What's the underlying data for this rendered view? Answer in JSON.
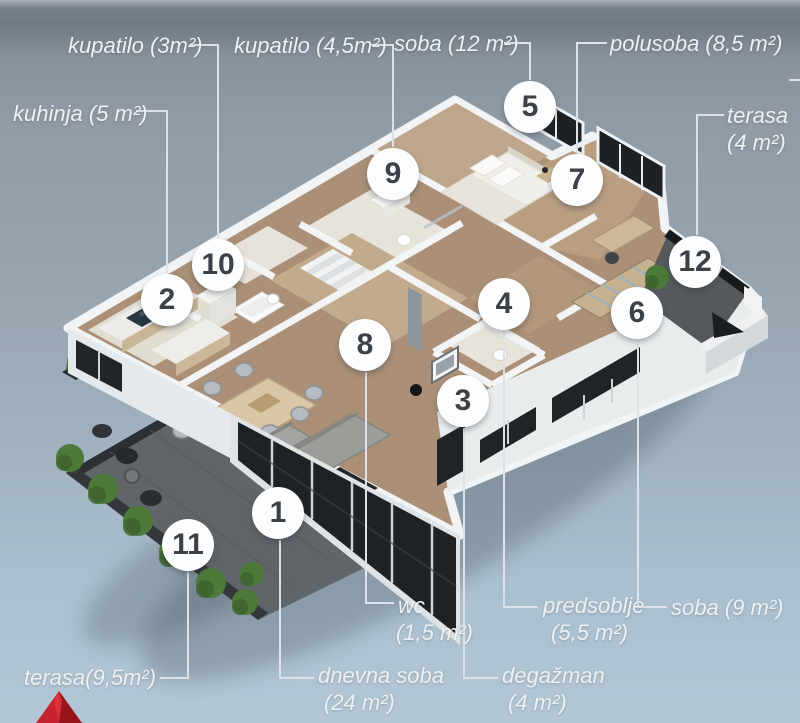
{
  "page": {
    "type": "apartment-floor-plan",
    "view": "3d-isometric"
  },
  "floor_plan": {
    "markers": [
      {
        "number": "1",
        "x": 278,
        "y": 513,
        "room": "dnevna soba"
      },
      {
        "number": "2",
        "x": 167,
        "y": 300,
        "room": "kuhinja"
      },
      {
        "number": "3",
        "x": 463,
        "y": 401,
        "room": "degažman"
      },
      {
        "number": "4",
        "x": 504,
        "y": 304,
        "room": "predsoblje"
      },
      {
        "number": "5",
        "x": 530,
        "y": 107,
        "room": "soba 12 m²"
      },
      {
        "number": "6",
        "x": 637,
        "y": 313,
        "room": "soba 9 m²"
      },
      {
        "number": "7",
        "x": 577,
        "y": 180,
        "room": "polusoba"
      },
      {
        "number": "8",
        "x": 365,
        "y": 345,
        "room": "wc"
      },
      {
        "number": "9",
        "x": 393,
        "y": 174,
        "room": "kupatilo 4,5 m²"
      },
      {
        "number": "10",
        "x": 218,
        "y": 265,
        "room": "kupatilo 3 m²"
      },
      {
        "number": "11",
        "x": 188,
        "y": 545,
        "room": "terasa 9,5 m²"
      },
      {
        "number": "12",
        "x": 695,
        "y": 262,
        "room": "terasa 4 m²"
      }
    ],
    "labels": [
      {
        "id": "kupatilo-3",
        "lines": [
          "kupatilo (3m²)"
        ],
        "x": 68,
        "y": 32,
        "align": "left"
      },
      {
        "id": "kupatilo-45",
        "lines": [
          "kupatilo (4,5m²)"
        ],
        "x": 234,
        "y": 32,
        "align": "left"
      },
      {
        "id": "soba-12",
        "lines": [
          "soba (12 m²)"
        ],
        "x": 394,
        "y": 30,
        "align": "left"
      },
      {
        "id": "polusoba-85",
        "lines": [
          "polusoba (8,5 m²)"
        ],
        "x": 610,
        "y": 30,
        "align": "left"
      },
      {
        "id": "kuhinja-5",
        "lines": [
          "kuhinja (5 m²)"
        ],
        "x": 13,
        "y": 100,
        "align": "left"
      },
      {
        "id": "terasa-4",
        "lines": [
          "terasa",
          "(4 m²)"
        ],
        "x": 727,
        "y": 102,
        "align": "left"
      },
      {
        "id": "terasa-95",
        "lines": [
          "terasa(9,5m²)"
        ],
        "x": 24,
        "y": 664,
        "align": "left"
      },
      {
        "id": "dnevna-soba",
        "lines": [
          "dnevna soba",
          "(24 m²)"
        ],
        "x": 318,
        "y": 662,
        "align": "left",
        "indent2": 6
      },
      {
        "id": "wc",
        "lines": [
          "wc",
          "(1,5 m²)"
        ],
        "x": 398,
        "y": 592,
        "align": "left",
        "indent2": -2
      },
      {
        "id": "predsoblje",
        "lines": [
          "predsoblje",
          "(5,5 m²)"
        ],
        "x": 543,
        "y": 592,
        "align": "left",
        "indent2": 8
      },
      {
        "id": "degazman",
        "lines": [
          "degažman",
          "(4 m²)"
        ],
        "x": 502,
        "y": 662,
        "align": "left",
        "indent2": 6
      },
      {
        "id": "soba-9",
        "lines": [
          "soba (9 m²)"
        ],
        "x": 671,
        "y": 594,
        "align": "left"
      }
    ],
    "leaders": [
      {
        "to": "10",
        "points": "190,45 218,45 218,238"
      },
      {
        "to": "2",
        "points": "136,111 167,111 167,273"
      },
      {
        "to": "9",
        "points": "370,45 393,45 393,147"
      },
      {
        "to": "5",
        "points": "504,43 530,43 530,80"
      },
      {
        "to": "7",
        "points": "607,43 577,43 577,153"
      },
      {
        "to": "12",
        "points": "724,115 697,115 697,235"
      },
      {
        "to": "edge-right",
        "points": "789,80 800,80"
      },
      {
        "to": "terasa-95",
        "points": "188,572 188,678 160,678"
      },
      {
        "to": "dnevna-soba",
        "points": "280,540 280,678 314,678"
      },
      {
        "to": "wc",
        "points": "366,372 366,603 394,603"
      },
      {
        "to": "degazman",
        "points": "464,428 464,678 498,678"
      },
      {
        "to": "predsoblje",
        "points": "504,331 504,607 538,607"
      },
      {
        "to": "soba-9",
        "points": "638,340 638,607 667,607"
      }
    ]
  },
  "colors": {
    "background_top": "#6e7984",
    "background_bottom": "#b2c6d4",
    "label_text": "#edf1f4",
    "leader_line": "#dce2e8",
    "marker_bg": "#fcfdfe",
    "marker_text": "#3b4149",
    "wall_white": "#f1f3f5",
    "wood_floor": "#ab9077",
    "window_dark": "#1d2226",
    "terrace_floor": "#5f6468",
    "bush_green": "#4d7a39",
    "arrow_red_light": "#c5242f",
    "arrow_red_dark": "#97141d"
  }
}
